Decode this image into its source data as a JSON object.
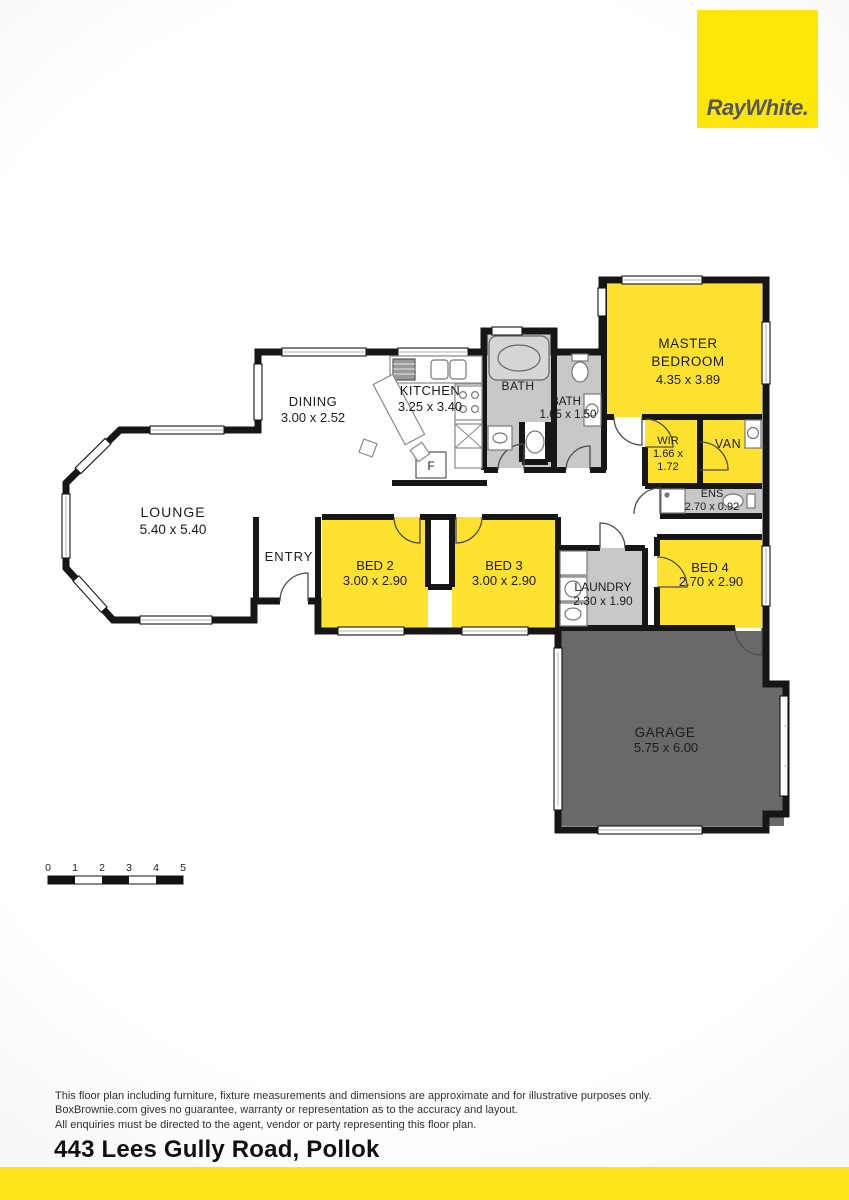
{
  "brand": {
    "logo_text": "RayWhite."
  },
  "floorplan": {
    "rooms": {
      "lounge": {
        "name": "LOUNGE",
        "dims": "5.40 x 5.40"
      },
      "dining": {
        "name": "DINING",
        "dims": "3.00 x 2.52"
      },
      "kitchen": {
        "name": "KITCHEN",
        "dims": "3.25 x 3.40"
      },
      "bath_main": {
        "name": "BATH"
      },
      "bath2": {
        "name": "BATH",
        "dims": "1.65 x 1.50"
      },
      "master": {
        "name_line1": "MASTER",
        "name_line2": "BEDROOM",
        "dims": "4.35 x 3.89"
      },
      "wir": {
        "name": "WIR",
        "dims_line1": "1.66 x",
        "dims_line2": "1.72"
      },
      "van": {
        "name": "VAN"
      },
      "ens": {
        "name": "ENS",
        "dims": "2.70 x 0.92"
      },
      "entry": {
        "name": "ENTRY"
      },
      "bed2": {
        "name": "BED 2",
        "dims": "3.00 x 2.90"
      },
      "bed3": {
        "name": "BED 3",
        "dims": "3.00 x 2.90"
      },
      "laundry": {
        "name": "LAUNDRY",
        "dims": "2.30 x 1.90"
      },
      "bed4": {
        "name": "BED 4",
        "dims": "2.70 x 2.90"
      },
      "garage": {
        "name": "GARAGE",
        "dims": "5.75 x 6.00"
      }
    },
    "labels": {
      "fridge": "F"
    },
    "colors": {
      "room_yellow": "#FFE12F",
      "wet_gray": "#C8C8C8",
      "garage_gray": "#696969",
      "wall": "#161616",
      "brand_yellow": "#FFE60A",
      "footer_yellow": "#FFE41C"
    }
  },
  "scale_bar": {
    "ticks": [
      "0",
      "1",
      "2",
      "3",
      "4",
      "5"
    ]
  },
  "footer": {
    "disclaimer_line1": "This floor plan including furniture, fixture measurements and dimensions are approximate and for illustrative purposes only.",
    "disclaimer_line2": "BoxBrownie.com gives no guarantee, warranty or representation as to the accuracy and layout.",
    "disclaimer_line3": "All enquiries must be directed to the agent, vendor or party representing this floor plan.",
    "address": "443 Lees Gully Road, Pollok"
  }
}
